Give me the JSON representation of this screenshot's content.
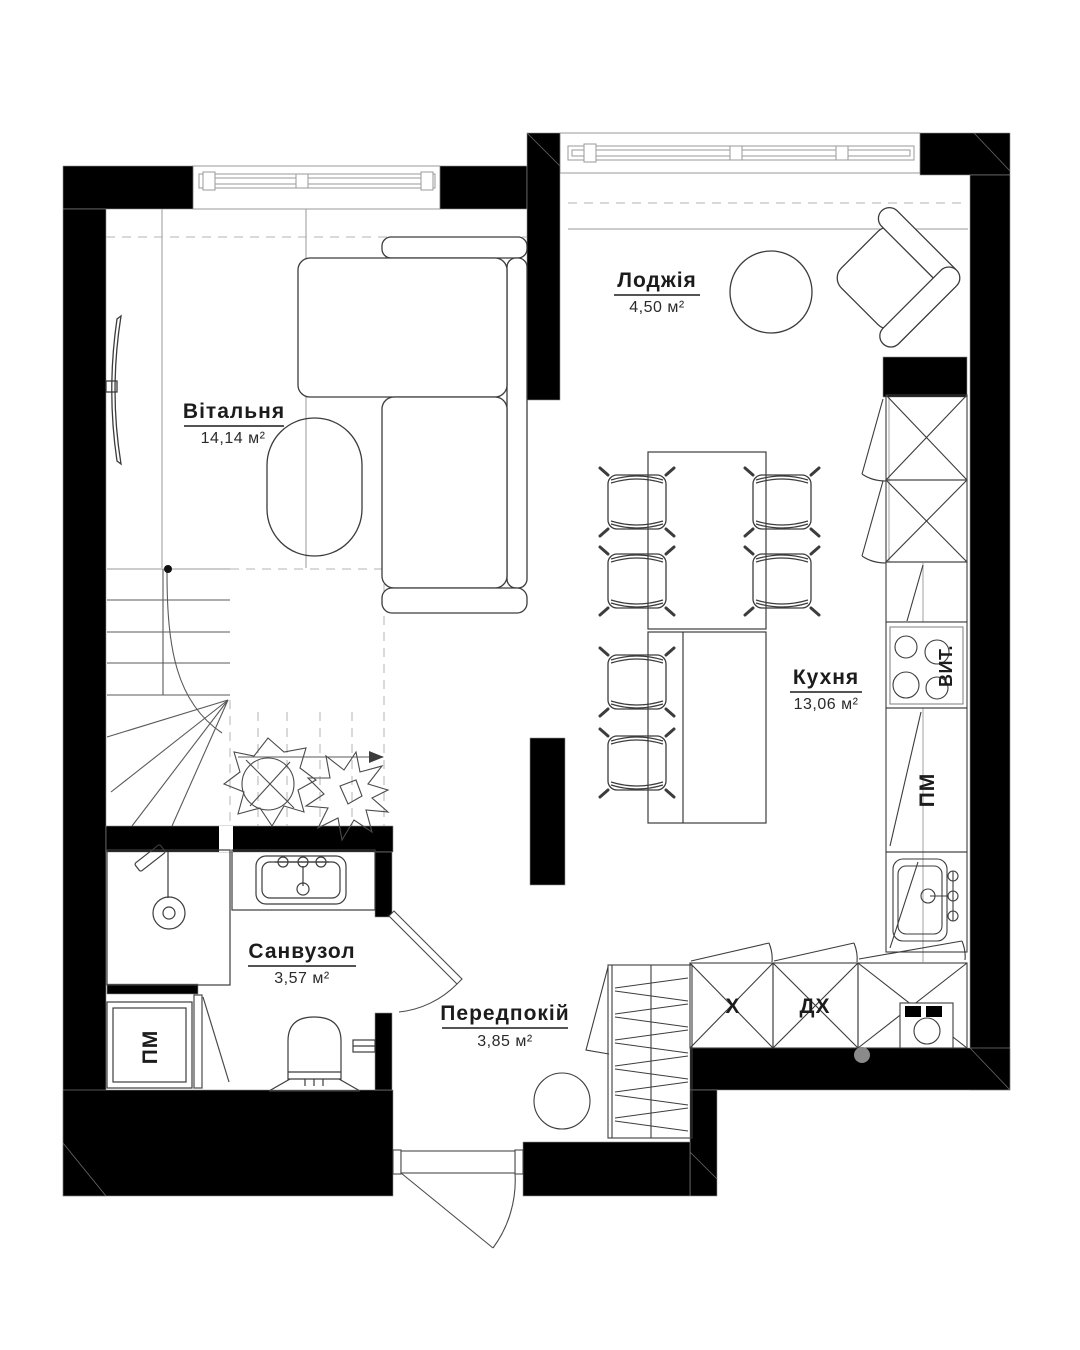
{
  "plan": {
    "title": "apartment-floor-plan",
    "rooms": {
      "living": {
        "name": "Вітальня",
        "area": "14,14 м²"
      },
      "loggia": {
        "name": "Лоджія",
        "area": "4,50 м²"
      },
      "kitchen": {
        "name": "Кухня",
        "area": "13,06 м²"
      },
      "bathroom": {
        "name": "Санвузол",
        "area": "3,57 м²"
      },
      "hallway": {
        "name": "Передпокій",
        "area": "3,85 м²"
      }
    },
    "appliance_labels": {
      "hood": "ВИТ.",
      "dishwasher": "ПМ",
      "washing_machine": "ПМ",
      "cabinet_x": "Х",
      "cabinet_dx": "ДХ"
    },
    "colors": {
      "wall": "#000000",
      "furniture_line": "#3c3c3c",
      "light_line": "#9a9a9a",
      "dashed_line": "#b3b3b3",
      "dot": "#8a8a8a",
      "text": "#1c1c1c",
      "background": "#ffffff"
    }
  }
}
